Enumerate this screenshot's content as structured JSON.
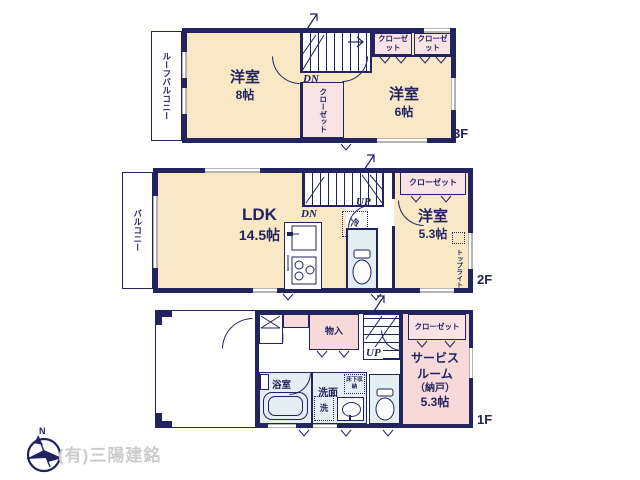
{
  "colors": {
    "wall": "#23235f",
    "cream": "#f8e8c6",
    "pink": "#f7d9d9",
    "cpink": "#fae3e5",
    "water": "#e4eff3",
    "wingray": "#b5b5b5",
    "cogray": "#cccccc"
  },
  "floors": {
    "f3": {
      "label": "3F",
      "roof_balcony": "ルーフバルコニー",
      "room_west": {
        "name": "洋室",
        "size": "8帖"
      },
      "room_east": {
        "name": "洋室",
        "size": "6帖"
      },
      "closet_center": "クローゼット",
      "closet_ne1": "クローゼット",
      "closet_ne2": "クローゼット",
      "stairs_dn": "DN"
    },
    "f2": {
      "label": "2F",
      "balcony": "バルコニー",
      "ldk": {
        "name": "LDK",
        "size": "14.5帖"
      },
      "room_east": {
        "name": "洋室",
        "size": "5.3帖"
      },
      "closet": "クローゼット",
      "stairs_dn": "DN",
      "stairs_up": "UP",
      "fridge": "冷",
      "top_light": "トップライト"
    },
    "f1": {
      "label": "1F",
      "entrance": "玄関",
      "storage": "物入",
      "stairs_up": "UP",
      "bathroom": "浴室",
      "washroom": "洗面",
      "laundry": "洗",
      "underfloor_storage": "床下収納",
      "service_room": {
        "line1": "サービス",
        "line2": "ルーム",
        "line3": "（納戸）",
        "size": "5.3帖"
      },
      "closet": "クローゼット"
    }
  },
  "footer": {
    "compass_n": "N",
    "company": "(有)三陽建銘"
  }
}
